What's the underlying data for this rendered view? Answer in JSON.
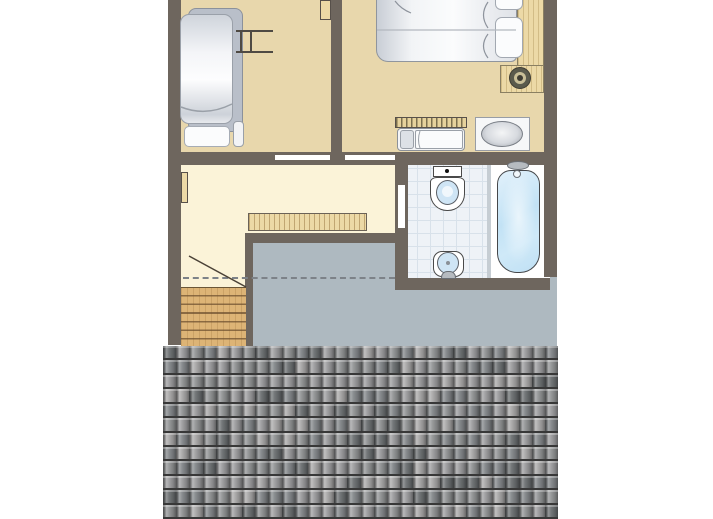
{
  "plan": {
    "type": "floorplan",
    "floor_label_visible": false,
    "rooms": [
      {
        "name": "bedroom-left",
        "fixtures": [
          "bunk-bed",
          "ladder",
          "pillow",
          "door-leaf"
        ]
      },
      {
        "name": "bedroom-right",
        "fixtures": [
          "double-bed",
          "pillows",
          "wood-bed-frame",
          "corner-knob",
          "baby-crib",
          "washbasin"
        ]
      },
      {
        "name": "bathroom",
        "fixtures": [
          "toilet",
          "hand-basin",
          "tap",
          "bathtub",
          "bath-faucet",
          "tiled-floor",
          "door-leaf"
        ]
      },
      {
        "name": "landing",
        "fixtures": [
          "stairs",
          "stair-direction-line",
          "railing",
          "radiator-or-door-leaf",
          "headroom-dashed-line"
        ]
      },
      {
        "name": "low-headroom-zone",
        "fixtures": []
      },
      {
        "name": "roof",
        "fixtures": [
          "roof-tiles"
        ]
      }
    ]
  },
  "colors": {
    "page": "#ffffff",
    "wall": "#6e665e",
    "tan": "#e8d7ac",
    "pale": "#fbf3d8",
    "grey": "#aeb9c0",
    "wood": "#ecd9a6",
    "stairwood": "#ddb476",
    "stairline": "#8a6a42",
    "tile": "#eef2f7",
    "tileline": "#d8e1ea",
    "blue": "#cfe5f5",
    "tubblue": "#bfe0f4"
  },
  "roof": {
    "cols": 30,
    "rows": 12,
    "palette": [
      "#6d7173",
      "#84888b",
      "#939596",
      "#9e9ea0",
      "#aaa9a9"
    ],
    "thresholds": [
      14,
      34,
      62,
      86
    ]
  }
}
